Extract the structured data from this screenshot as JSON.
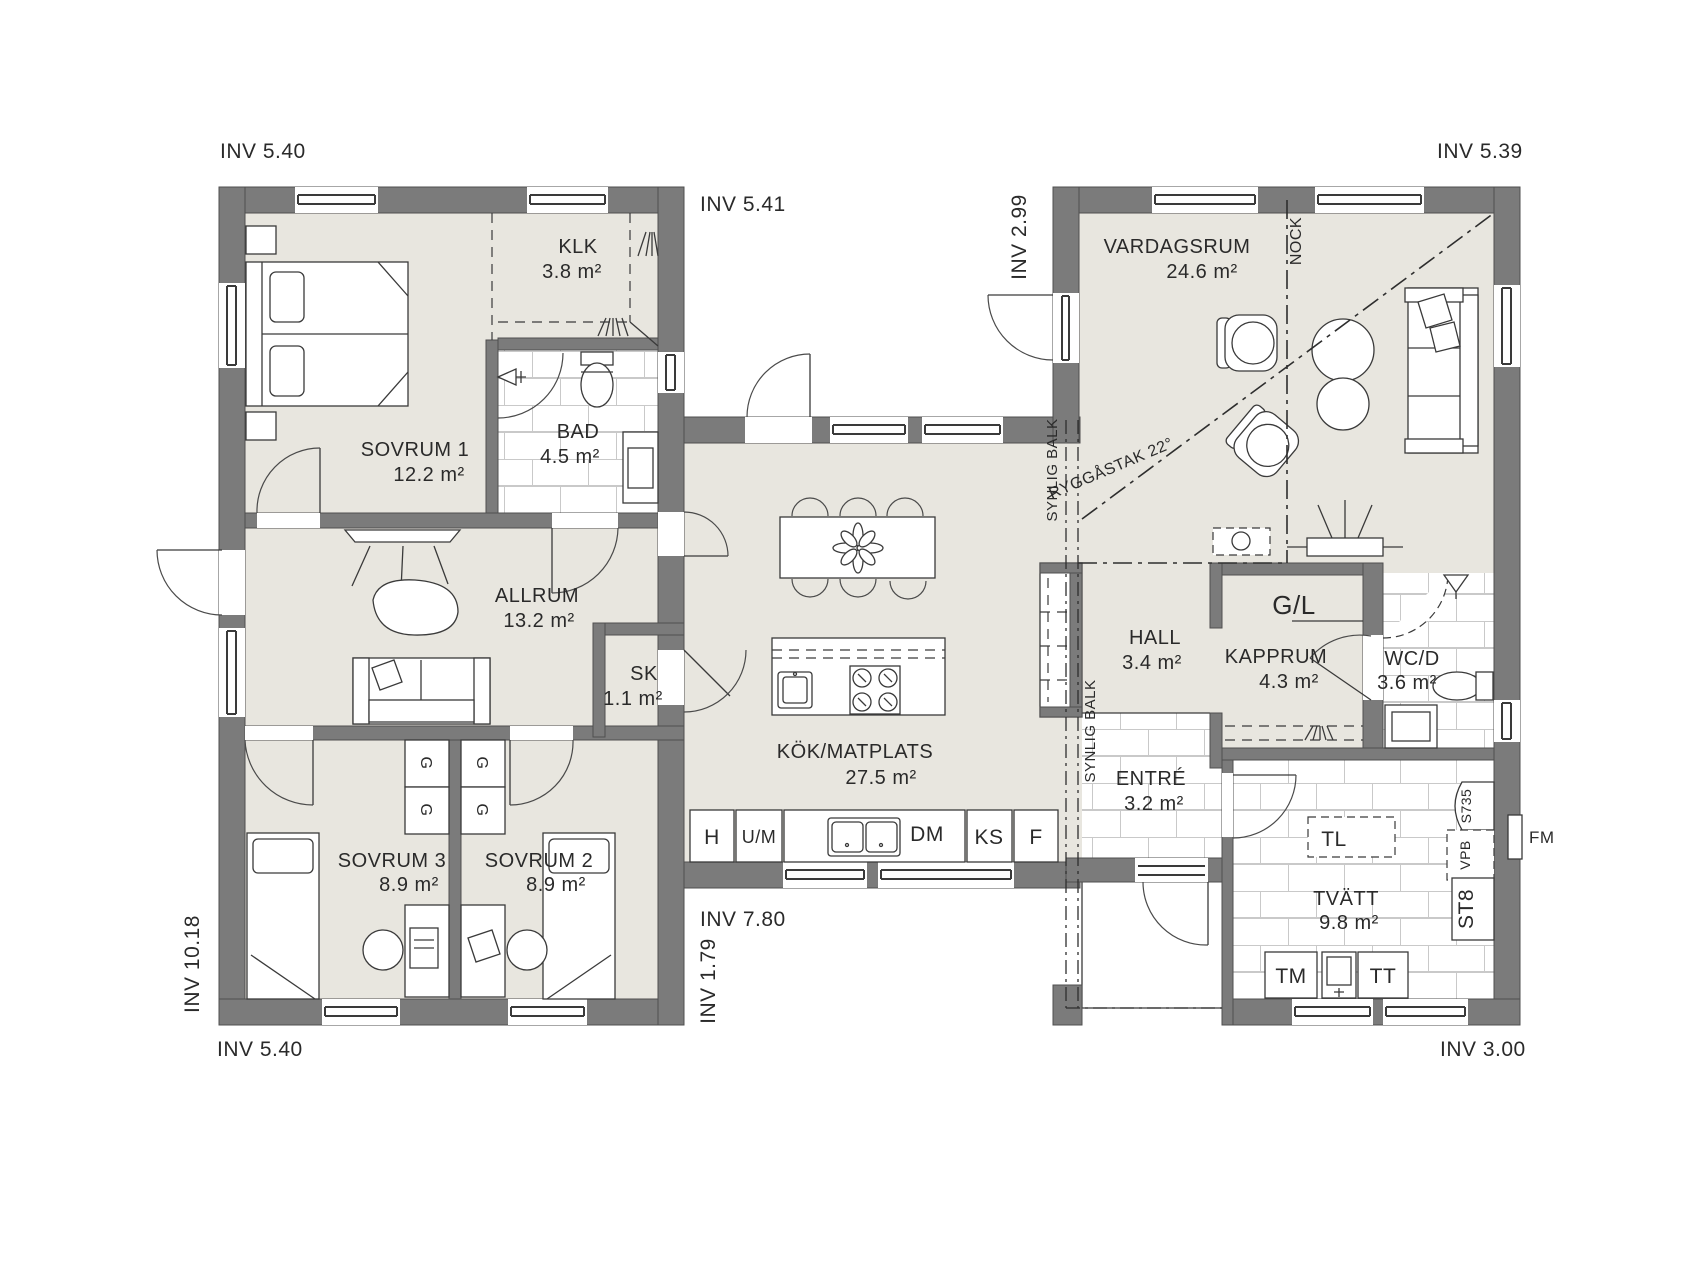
{
  "colors": {
    "wall": "#7b7b7b",
    "floor": "#e8e6df",
    "tile_line": "#c9c9c9",
    "line": "#3a3a3a",
    "background": "#ffffff"
  },
  "dims": {
    "top_left": "INV 5.40",
    "mid_top": "INV 5.41",
    "wing_gap": "INV 2.99",
    "top_right": "INV 5.39",
    "left_side": "INV 10.18",
    "bottom_left": "INV 5.40",
    "mid_bottom": "INV 7.80",
    "mid_bottom_v": "INV 1.79",
    "bottom_right": "INV 3.00"
  },
  "rooms": {
    "sovrum1": {
      "name": "SOVRUM 1",
      "area": "12.2 m²"
    },
    "klk": {
      "name": "KLK",
      "area": "3.8 m²"
    },
    "bad": {
      "name": "BAD",
      "area": "4.5 m²"
    },
    "allrum": {
      "name": "ALLRUM",
      "area": "13.2 m²"
    },
    "sk": {
      "name": "SK",
      "area": "1.1 m²"
    },
    "sovrum3": {
      "name": "SOVRUM 3",
      "area": "8.9 m²"
    },
    "sovrum2": {
      "name": "SOVRUM 2",
      "area": "8.9 m²"
    },
    "kok": {
      "name": "KÖK/MATPLATS",
      "area": "27.5 m²"
    },
    "vardagsrum": {
      "name": "VARDAGSRUM",
      "area": "24.6 m²"
    },
    "hall": {
      "name": "HALL",
      "area": "3.4 m²"
    },
    "kapprum": {
      "name": "KAPPRUM",
      "area": "4.3 m²"
    },
    "wcd": {
      "name": "WC/D",
      "area": "3.6 m²"
    },
    "entre": {
      "name": "ENTRÉ",
      "area": "3.2 m²"
    },
    "tvatt": {
      "name": "TVÄTT",
      "area": "9.8 m²"
    }
  },
  "fixtures": {
    "gl": "G/L",
    "g": "G",
    "tl": "TL",
    "tm": "TM",
    "tt": "TT",
    "st8": "ST8",
    "vpb": "VPB",
    "s735": "S735",
    "fm": "FM",
    "h": "H",
    "um": "U/M",
    "dm": "DM",
    "ks": "KS",
    "f": "F"
  },
  "annotations": {
    "nock": "NOCK",
    "ryggastak": "RYGGÅSTAK 22°",
    "synlig_balk": "SYNLIG BALK"
  }
}
